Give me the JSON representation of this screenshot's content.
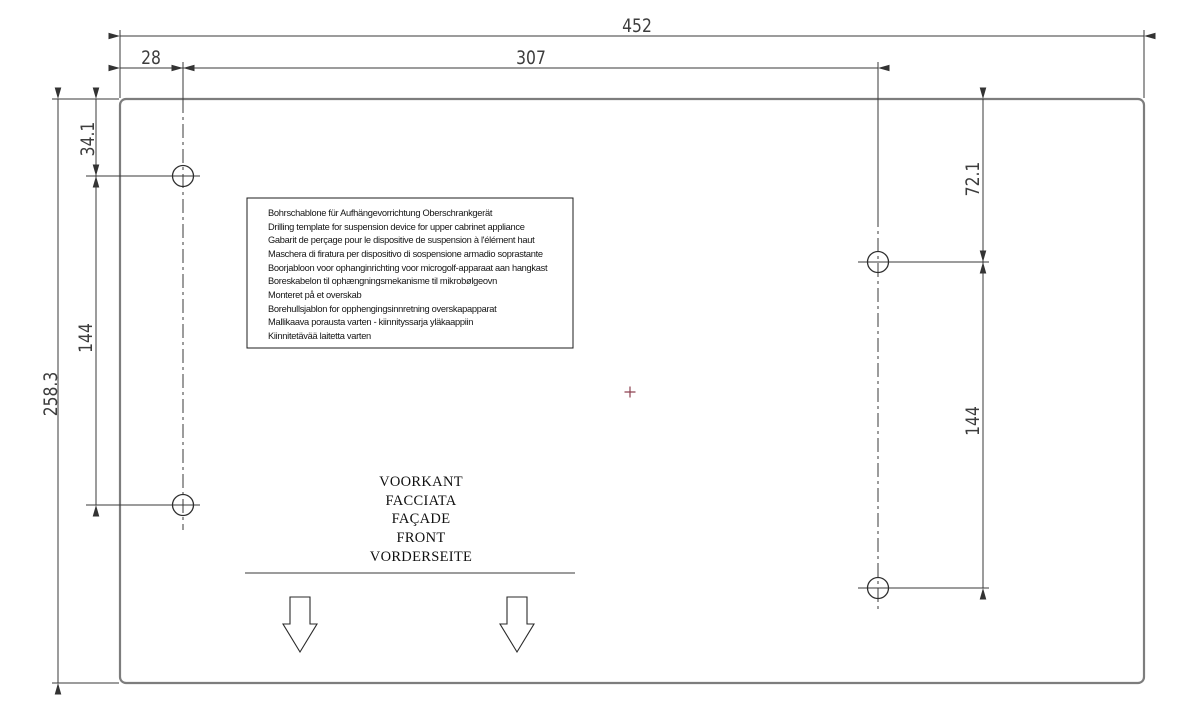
{
  "dimensions": {
    "overall_width": "452",
    "left_hole_inset": "28",
    "hole_horizontal_span": "307",
    "overall_height": "258.3",
    "left_top_hole_offset": "34.1",
    "left_hole_spacing": "144",
    "right_top_hole_offset": "72.1",
    "right_hole_spacing": "144"
  },
  "instruction_box": {
    "lines": [
      "Bohrschablone für Aufhängevorrichtung Oberschrankgerät",
      "Drilling template for suspension device for upper cabrinet appliance",
      "Gabarit de perçage pour le dispositive de suspension à l'élément haut",
      "Maschera di firatura per dispositivo di sospensione armadio soprastante",
      "Boorjabloon voor ophanginrichting voor microgolf-apparaat aan hangkast",
      "Boreskabelon til ophængningsmekanisme til mikrobølgeovn",
      "Monteret på et overskab",
      "Borehullsjablon for opphengingsinnretning overskapapparat",
      "Mallikaava porausta varten - kiinnityssarja yläkaappiin",
      "Kiinnitetävää laitetta varten"
    ]
  },
  "front_labels": {
    "dutch": "VOORKANT",
    "italian": "FACCIATA",
    "french": "FAÇADE",
    "english": "FRONT",
    "german": "VORDERSEITE"
  },
  "colors": {
    "background": "#ffffff",
    "template_outline": "#7d7d7d",
    "drawing_lines": "#3a3a3a",
    "text": "#151515",
    "center_mark": "#8d4150"
  }
}
